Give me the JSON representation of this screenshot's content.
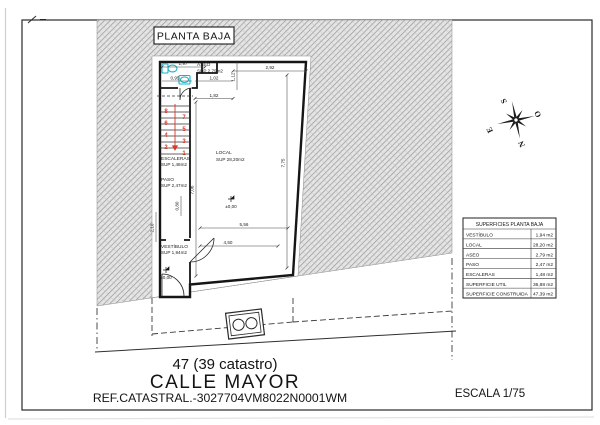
{
  "page": {
    "title": "PLANTA BAJA",
    "compass": {
      "n": "N",
      "s": "S",
      "e": "E",
      "o": "O"
    },
    "plan": {
      "rooms": [
        {
          "name": "ASEO",
          "sup": "SUP 2,79m2"
        },
        {
          "name": "ESCALERAS",
          "sup": "SUP 1,48m2"
        },
        {
          "name": "PASO",
          "sup": "SUP 2,47m2"
        },
        {
          "name": "VESTÍBULO",
          "sup": "SUP 1,94m2"
        },
        {
          "name": "LOCAL",
          "sup": "SUP 28,20m2"
        }
      ],
      "level_markers": [
        "±0,00",
        "±0,00"
      ],
      "stair_numbers": [
        "1",
        "2",
        "3",
        "4",
        "5",
        "6",
        "7",
        "8"
      ],
      "dimensions": {
        "aseo_width": "1,97",
        "aseo_left": "0,95",
        "aseo_door": "1,02",
        "aseo_bottom": "1,82",
        "facade_top": "2,92",
        "notch_depth": "1,12",
        "local_depth_right": "7,75",
        "local_depth_left": "7,06",
        "local_width_upper": "5,56",
        "local_width_lower": "4,50",
        "vestibulo_height": "2,10",
        "paso_width": "0,80"
      }
    },
    "table": {
      "title": "SUPERFICIES PLANTA BAJA",
      "rows": [
        {
          "label": "VESTÍBULO",
          "value": "1,94 m2"
        },
        {
          "label": "LOCAL",
          "value": "28,20 m2"
        },
        {
          "label": "ASEO",
          "value": "2,79 m2"
        },
        {
          "label": "PASO",
          "value": "2,47 m2"
        },
        {
          "label": "ESCALERAS",
          "value": "1,48 m2"
        },
        {
          "label": "SUPERFICIE UTIL",
          "value": "36,88 m2"
        },
        {
          "label": "SUPERFICIE CONSTRUIDA",
          "value": "47,39 m2"
        }
      ]
    },
    "footer": {
      "address_number": "47 (39 catastro)",
      "street": "CALLE MAYOR",
      "catastral_ref": "REF.CATASTRAL.-3027704VM8022N0001WM",
      "scale": "ESCALA 1/75"
    },
    "colors": {
      "hatch_line": "#969696",
      "fixture": "#19b6c9",
      "stair_red": "#d8382b"
    }
  }
}
